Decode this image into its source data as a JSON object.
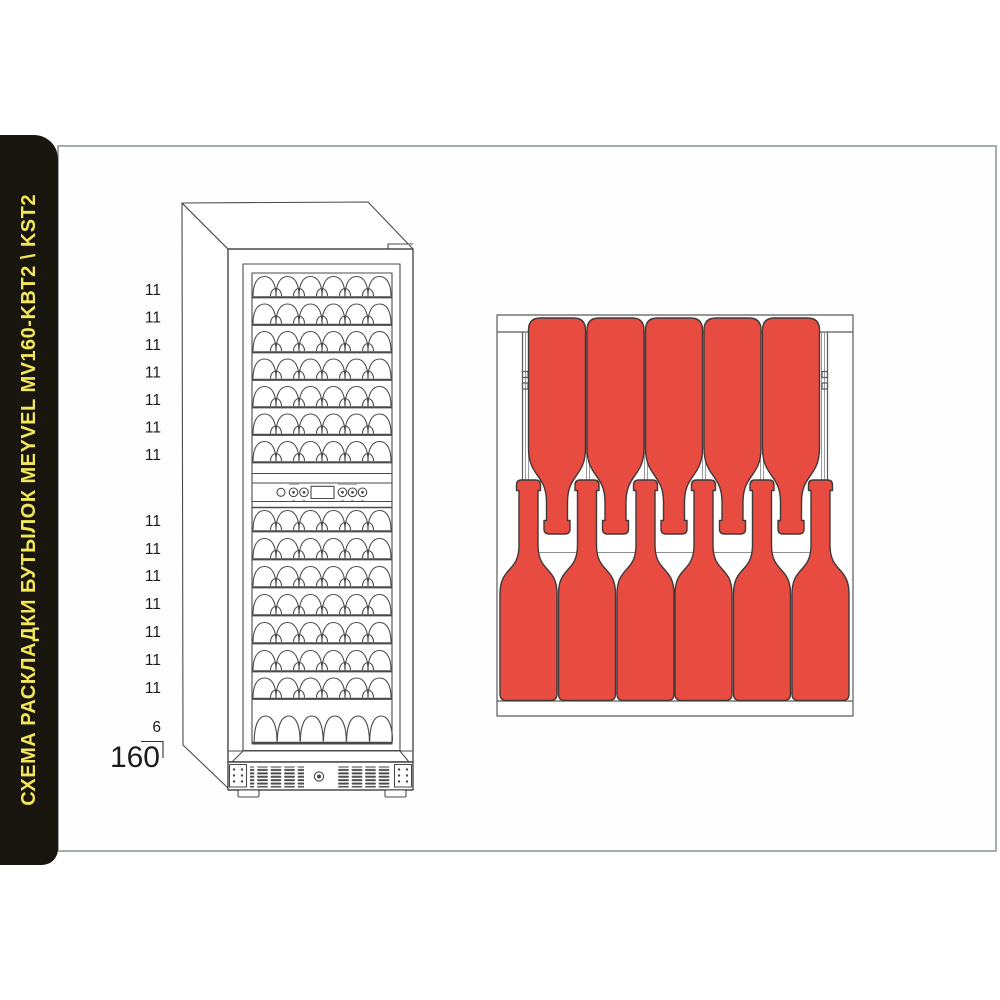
{
  "sidebar": {
    "title": "СХЕМА РАСКЛАДКИ БУТЫЛОК MEYVEL MV160-KBT2 \\ KST2"
  },
  "cabinet": {
    "model": "MEYVEL MV160-KBT2 \\ KST2",
    "upper_zone_counts": [
      "11",
      "11",
      "11",
      "11",
      "11",
      "11",
      "11"
    ],
    "lower_zone_counts": [
      "11",
      "11",
      "11",
      "11",
      "11",
      "11",
      "11"
    ],
    "floor_row_count": "6",
    "total_capacity": "160"
  },
  "rack": {
    "inverted_bottles_top_row": 5,
    "upright_bottles_bottom_row": 6
  },
  "colors": {
    "bottle_red": "#e84b40",
    "banner_black": "#18160e",
    "banner_yellow": "#f3e65b",
    "panel_border_gray": "#a5aeab",
    "line_gray": "#4a4a4a"
  }
}
